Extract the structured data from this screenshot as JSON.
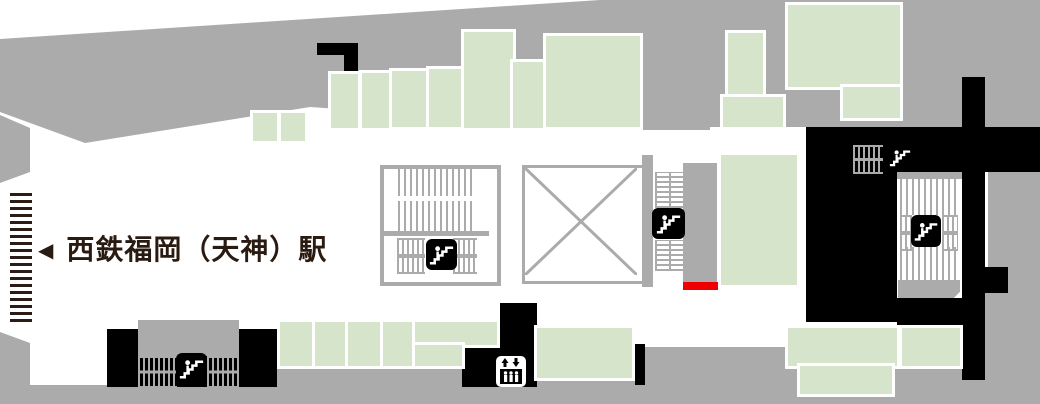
{
  "map": {
    "kind": "station floor map",
    "station_label": {
      "arrow": "◀",
      "text": "西鉄福岡（天神）駅"
    },
    "icons": {
      "escalator": "escalator-icon (white pictogram on black rounded square)",
      "elevator": "elevator-icon (black cabin with up/down arrows on white rounded square)"
    },
    "marker": {
      "name": "red-location-bar",
      "color": "#EE0000"
    },
    "colors": {
      "area_gray": "#ABABAB",
      "shop_green": "#D5E4CB",
      "structure_black": "#000000",
      "label_dark": "#2A1B12",
      "background": "#FFFFFF"
    }
  }
}
